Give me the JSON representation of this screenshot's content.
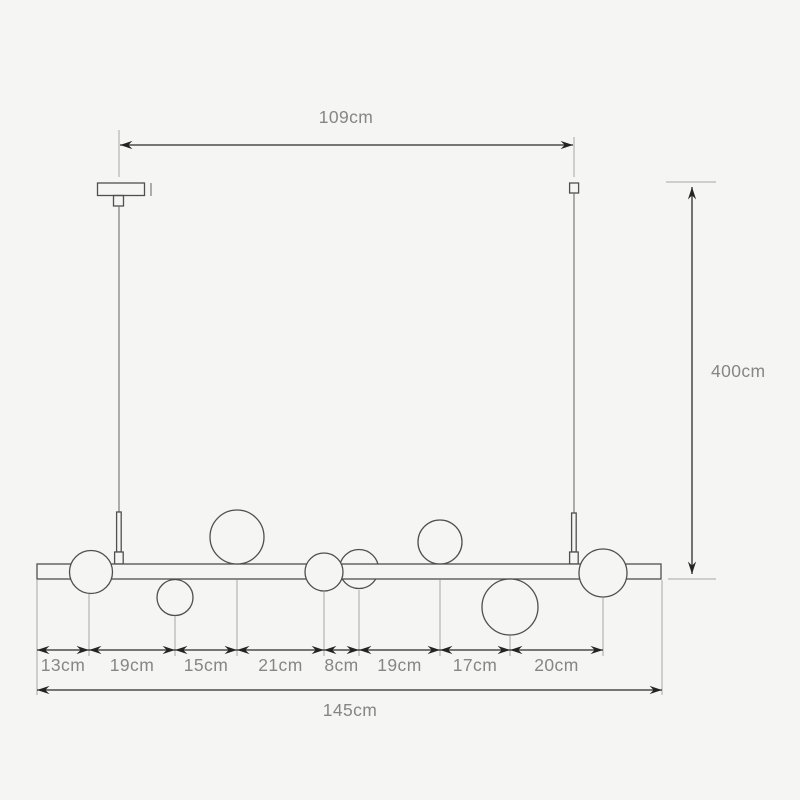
{
  "diagram": {
    "type": "pendant-light-dimension-drawing",
    "top_span_label": "109cm",
    "top_span_cm": 109,
    "drop_height_label": "400cm",
    "drop_height_cm": 400,
    "total_length_label": "145cm",
    "total_length_cm": 145,
    "segment_labels": [
      "13cm",
      "19cm",
      "15cm",
      "21cm",
      "8cm",
      "19cm",
      "17cm",
      "20cm"
    ],
    "segments_cm": [
      13,
      19,
      15,
      21,
      8,
      19,
      17,
      20
    ]
  },
  "colors": {
    "background": "#f5f5f4",
    "dimension_line": "#2b2b2b",
    "drawing_outline": "#4f4f4f",
    "extension_line": "#a8a8a8",
    "label_text": "#868686"
  }
}
